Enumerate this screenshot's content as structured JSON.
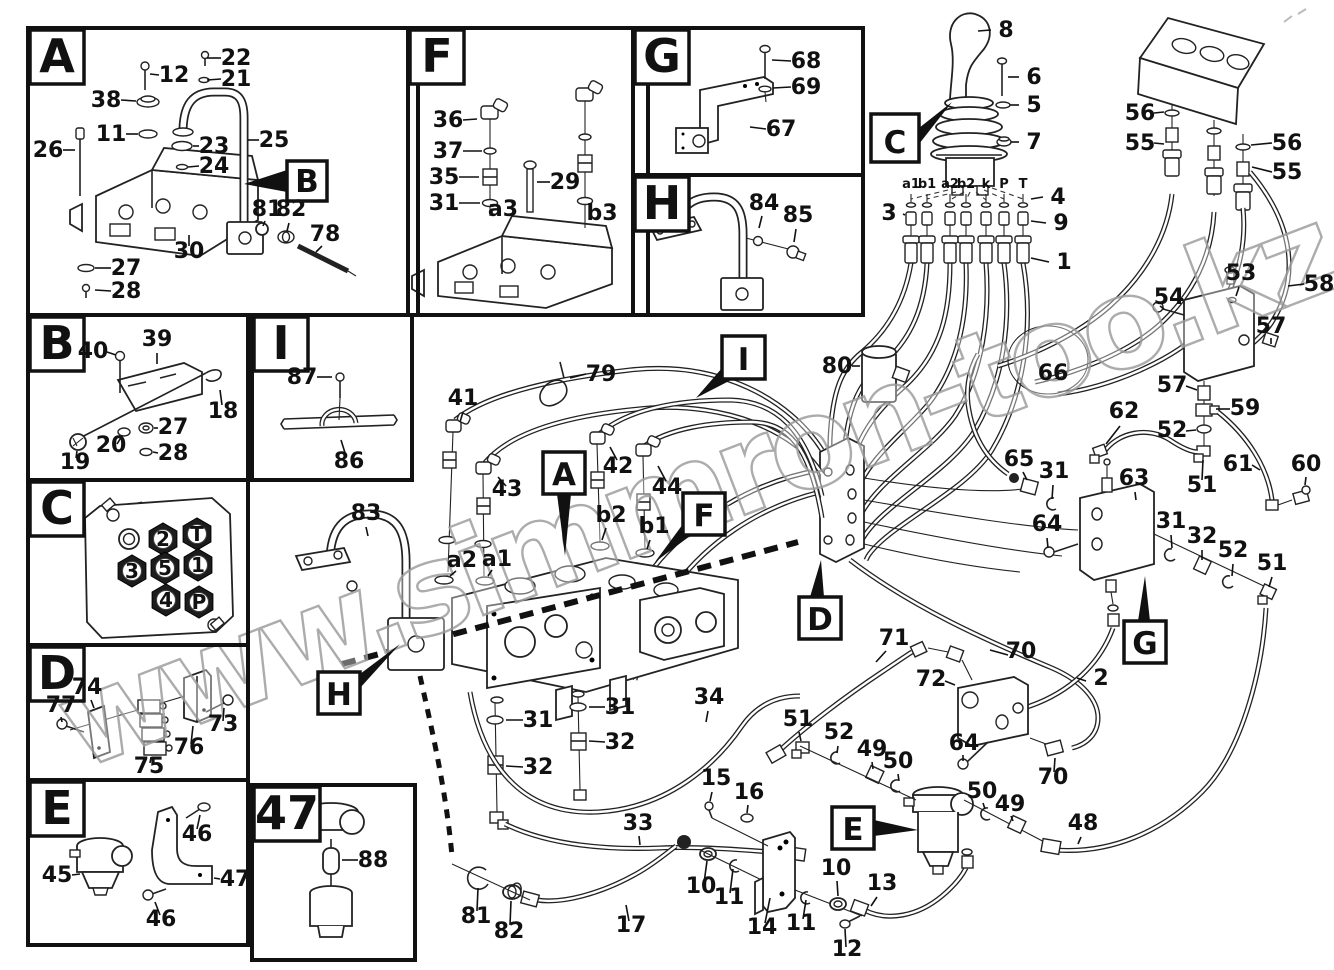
{
  "watermark": {
    "text": "www.simmron-too.kz"
  },
  "colors": {
    "line": "#1a1a1a",
    "background": "#ffffff",
    "watermark": "#9e9e9e"
  },
  "sections": [
    {
      "id": "A",
      "label": "A",
      "x": 28,
      "y": 28,
      "w": 390,
      "h": 287
    },
    {
      "id": "F",
      "label": "F",
      "x": 408,
      "y": 28,
      "w": 240,
      "h": 287
    },
    {
      "id": "G",
      "label": "G",
      "x": 633,
      "y": 28,
      "w": 230,
      "h": 147
    },
    {
      "id": "H",
      "label": "H",
      "x": 633,
      "y": 175,
      "w": 230,
      "h": 140
    },
    {
      "id": "B",
      "label": "B",
      "x": 28,
      "y": 315,
      "w": 220,
      "h": 165
    },
    {
      "id": "I",
      "label": "I",
      "x": 252,
      "y": 315,
      "w": 160,
      "h": 165
    },
    {
      "id": "C",
      "label": "C",
      "x": 28,
      "y": 480,
      "w": 220,
      "h": 165
    },
    {
      "id": "D",
      "label": "D",
      "x": 28,
      "y": 645,
      "w": 220,
      "h": 135
    },
    {
      "id": "E",
      "label": "E",
      "x": 28,
      "y": 780,
      "w": 220,
      "h": 165
    },
    {
      "id": "47",
      "label": "47",
      "x": 252,
      "y": 785,
      "w": 163,
      "h": 175,
      "lw": 66
    }
  ],
  "callouts": [
    {
      "ref": "b-in-a",
      "label": "B",
      "x": 287,
      "y": 161,
      "s": 40,
      "tri": "287,170 287,192 244,184"
    },
    {
      "ref": "c-main",
      "label": "C",
      "x": 871,
      "y": 114,
      "s": 48,
      "tri": "919,128 919,144 952,102"
    },
    {
      "ref": "a-main",
      "label": "A",
      "x": 543,
      "y": 452,
      "s": 42,
      "tri": "557,494 571,494 565,556"
    },
    {
      "ref": "f-main",
      "label": "F",
      "x": 683,
      "y": 493,
      "s": 42,
      "tri": "683,524 694,533 655,562"
    },
    {
      "ref": "i-main",
      "label": "I",
      "x": 722,
      "y": 336,
      "s": 43,
      "tri": "722,368 733,379 696,398"
    },
    {
      "ref": "d-main",
      "label": "D",
      "x": 799,
      "y": 597,
      "s": 42,
      "tri": "810,597 824,597 821,560"
    },
    {
      "ref": "g-main",
      "label": "G",
      "x": 1124,
      "y": 621,
      "s": 42,
      "tri": "1138,621 1150,621 1145,576"
    },
    {
      "ref": "h-main",
      "label": "H",
      "x": 318,
      "y": 672,
      "s": 42,
      "tri": "360,674 360,688 400,644"
    },
    {
      "ref": "e-main",
      "label": "E",
      "x": 832,
      "y": 807,
      "s": 42,
      "tri": "874,820 874,836 918,830"
    }
  ],
  "joystick_ports": [
    {
      "t": "a1",
      "x": 911
    },
    {
      "t": "b1",
      "x": 927
    },
    {
      "t": "a2",
      "x": 950
    },
    {
      "t": "b2",
      "x": 966
    },
    {
      "t": "k",
      "x": 986
    },
    {
      "t": "P",
      "x": 1004
    },
    {
      "t": "T",
      "x": 1023
    }
  ],
  "port_row": {
    "label_y": 188
  },
  "connector_ports": [
    {
      "t": "2",
      "x": 163,
      "y": 539
    },
    {
      "t": "T",
      "x": 197,
      "y": 534
    },
    {
      "t": "3",
      "x": 132,
      "y": 571
    },
    {
      "t": "5",
      "x": 165,
      "y": 568
    },
    {
      "t": "1",
      "x": 198,
      "y": 565
    },
    {
      "t": "4",
      "x": 166,
      "y": 600
    },
    {
      "t": "P",
      "x": 199,
      "y": 602
    }
  ],
  "part_labels": [
    {
      "t": "22",
      "x": 236,
      "y": 65,
      "l": [
        221,
        58,
        207,
        58
      ]
    },
    {
      "t": "21",
      "x": 236,
      "y": 86,
      "l": [
        221,
        79,
        207,
        80
      ]
    },
    {
      "t": "12",
      "x": 174,
      "y": 82,
      "l": [
        159,
        75,
        150,
        74
      ]
    },
    {
      "t": "38",
      "x": 106,
      "y": 107,
      "l": [
        121,
        100,
        136,
        101
      ]
    },
    {
      "t": "11",
      "x": 111,
      "y": 141,
      "l": [
        126,
        134,
        138,
        134
      ]
    },
    {
      "t": "26",
      "x": 48,
      "y": 157,
      "l": [
        63,
        150,
        75,
        150
      ]
    },
    {
      "t": "23",
      "x": 214,
      "y": 153,
      "l": [
        199,
        146,
        193,
        146
      ]
    },
    {
      "t": "24",
      "x": 214,
      "y": 173,
      "l": [
        199,
        166,
        188,
        167
      ]
    },
    {
      "t": "25",
      "x": 274,
      "y": 147,
      "l": [
        259,
        140,
        248,
        140
      ]
    },
    {
      "t": "81",
      "x": 267,
      "y": 216,
      "l": [
        265,
        221,
        263,
        226
      ]
    },
    {
      "t": "82",
      "x": 291,
      "y": 216,
      "l": [
        289,
        223,
        287,
        231
      ]
    },
    {
      "t": "78",
      "x": 325,
      "y": 241,
      "l": [
        322,
        246,
        316,
        252
      ]
    },
    {
      "t": "30",
      "x": 189,
      "y": 258,
      "l": [
        189,
        246,
        189,
        235
      ]
    },
    {
      "t": "27",
      "x": 126,
      "y": 275,
      "l": [
        111,
        268,
        95,
        268
      ]
    },
    {
      "t": "28",
      "x": 126,
      "y": 298,
      "l": [
        111,
        291,
        95,
        290
      ]
    },
    {
      "t": "40",
      "x": 93,
      "y": 358,
      "l": [
        107,
        352,
        116,
        355
      ]
    },
    {
      "t": "39",
      "x": 157,
      "y": 346,
      "l": [
        157,
        353,
        157,
        364
      ]
    },
    {
      "t": "18",
      "x": 223,
      "y": 418,
      "l": [
        222,
        405,
        220,
        390
      ]
    },
    {
      "t": "27",
      "x": 173,
      "y": 434,
      "l": [
        158,
        428,
        154,
        428
      ]
    },
    {
      "t": "20",
      "x": 111,
      "y": 452,
      "l": [
        117,
        444,
        122,
        436
      ]
    },
    {
      "t": "28",
      "x": 173,
      "y": 460,
      "l": [
        158,
        453,
        153,
        452
      ]
    },
    {
      "t": "19",
      "x": 75,
      "y": 469,
      "l": [
        76,
        458,
        77,
        451
      ]
    },
    {
      "t": "77",
      "x": 61,
      "y": 712,
      "l": [
        61,
        717,
        62,
        722
      ]
    },
    {
      "t": "74",
      "x": 87,
      "y": 694,
      "l": [
        91,
        700,
        94,
        708
      ]
    },
    {
      "t": "75",
      "x": 149,
      "y": 773,
      "l": [
        150,
        763,
        151,
        757
      ]
    },
    {
      "t": "76",
      "x": 189,
      "y": 754,
      "l": [
        191,
        744,
        193,
        726
      ]
    },
    {
      "t": "73",
      "x": 223,
      "y": 731,
      "l": [
        223,
        721,
        224,
        708
      ]
    },
    {
      "t": "46",
      "x": 197,
      "y": 841,
      "l": [
        197,
        829,
        200,
        815
      ]
    },
    {
      "t": "45",
      "x": 57,
      "y": 882,
      "l": [
        72,
        875,
        80,
        874
      ]
    },
    {
      "t": "47",
      "x": 235,
      "y": 886,
      "l": [
        220,
        879,
        214,
        878
      ]
    },
    {
      "t": "46",
      "x": 161,
      "y": 926,
      "l": [
        160,
        915,
        155,
        902
      ]
    },
    {
      "t": "87",
      "x": 302,
      "y": 384,
      "l": [
        317,
        377,
        332,
        377
      ]
    },
    {
      "t": "86",
      "x": 349,
      "y": 468,
      "l": [
        346,
        456,
        341,
        440
      ]
    },
    {
      "t": "88",
      "x": 373,
      "y": 867,
      "l": [
        358,
        860,
        342,
        860
      ]
    },
    {
      "t": "36",
      "x": 448,
      "y": 127,
      "l": [
        463,
        120,
        477,
        119
      ]
    },
    {
      "t": "37",
      "x": 448,
      "y": 158,
      "l": [
        463,
        151,
        482,
        151
      ]
    },
    {
      "t": "35",
      "x": 444,
      "y": 184,
      "l": [
        459,
        177,
        479,
        177
      ]
    },
    {
      "t": "31",
      "x": 444,
      "y": 210,
      "l": [
        459,
        203,
        480,
        203
      ]
    },
    {
      "t": "29",
      "x": 565,
      "y": 189,
      "l": [
        550,
        182,
        537,
        182
      ]
    },
    {
      "t": "a3",
      "x": 503,
      "y": 216
    },
    {
      "t": "b3",
      "x": 602,
      "y": 220
    },
    {
      "t": "68",
      "x": 806,
      "y": 68,
      "l": [
        791,
        61,
        772,
        60
      ]
    },
    {
      "t": "69",
      "x": 806,
      "y": 94,
      "l": [
        791,
        87,
        773,
        88
      ]
    },
    {
      "t": "67",
      "x": 781,
      "y": 136,
      "l": [
        766,
        129,
        750,
        127
      ]
    },
    {
      "t": "84",
      "x": 764,
      "y": 210,
      "l": [
        762,
        216,
        759,
        228
      ]
    },
    {
      "t": "85",
      "x": 798,
      "y": 222,
      "l": [
        796,
        229,
        794,
        242
      ]
    },
    {
      "t": "8",
      "x": 1006,
      "y": 37,
      "l": [
        991,
        30,
        978,
        31
      ]
    },
    {
      "t": "6",
      "x": 1034,
      "y": 84,
      "l": [
        1019,
        77,
        1008,
        77
      ]
    },
    {
      "t": "5",
      "x": 1034,
      "y": 112,
      "l": [
        1019,
        105,
        1010,
        105
      ]
    },
    {
      "t": "7",
      "x": 1034,
      "y": 149,
      "l": [
        1019,
        142,
        1011,
        142
      ]
    },
    {
      "t": "4",
      "x": 1058,
      "y": 204,
      "l": [
        1043,
        197,
        1031,
        199
      ]
    },
    {
      "t": "3",
      "x": 889,
      "y": 220,
      "l": [
        903,
        214,
        905,
        215
      ]
    },
    {
      "t": "9",
      "x": 1061,
      "y": 230,
      "l": [
        1046,
        223,
        1031,
        221
      ]
    },
    {
      "t": "1",
      "x": 1064,
      "y": 269,
      "l": [
        1049,
        262,
        1031,
        258
      ]
    },
    {
      "t": "56",
      "x": 1140,
      "y": 120,
      "l": [
        1154,
        113,
        1164,
        112
      ]
    },
    {
      "t": "55",
      "x": 1140,
      "y": 150,
      "l": [
        1154,
        143,
        1164,
        144
      ]
    },
    {
      "t": "56",
      "x": 1287,
      "y": 150,
      "l": [
        1272,
        143,
        1251,
        145
      ]
    },
    {
      "t": "55",
      "x": 1287,
      "y": 179,
      "l": [
        1272,
        172,
        1252,
        167
      ]
    },
    {
      "t": "58",
      "x": 1319,
      "y": 291,
      "l": [
        1304,
        284,
        1288,
        286
      ]
    },
    {
      "t": "53",
      "x": 1241,
      "y": 280,
      "l": [
        1239,
        287,
        1236,
        296
      ]
    },
    {
      "t": "54",
      "x": 1169,
      "y": 304,
      "l": [
        1164,
        309,
        1160,
        306
      ]
    },
    {
      "t": "57",
      "x": 1271,
      "y": 333,
      "l": [
        1271,
        338,
        1271,
        344
      ]
    },
    {
      "t": "57",
      "x": 1172,
      "y": 392,
      "l": [
        1186,
        386,
        1197,
        390
      ]
    },
    {
      "t": "59",
      "x": 1245,
      "y": 415,
      "l": [
        1230,
        409,
        1216,
        409
      ]
    },
    {
      "t": "62",
      "x": 1124,
      "y": 418,
      "l": [
        1120,
        426,
        1106,
        444
      ]
    },
    {
      "t": "52",
      "x": 1172,
      "y": 437,
      "l": [
        1186,
        431,
        1196,
        430
      ]
    },
    {
      "t": "61",
      "x": 1238,
      "y": 471,
      "l": [
        1252,
        465,
        1260,
        470
      ]
    },
    {
      "t": "60",
      "x": 1306,
      "y": 471,
      "l": [
        1306,
        477,
        1305,
        485
      ]
    },
    {
      "t": "51",
      "x": 1202,
      "y": 492,
      "l": [
        1202,
        480,
        1203,
        460
      ]
    },
    {
      "t": "66",
      "x": 1053,
      "y": 380
    },
    {
      "t": "80",
      "x": 837,
      "y": 373,
      "l": [
        852,
        366,
        860,
        366
      ]
    },
    {
      "t": "65",
      "x": 1019,
      "y": 466,
      "l": [
        1023,
        472,
        1027,
        480
      ]
    },
    {
      "t": "31",
      "x": 1054,
      "y": 478,
      "l": [
        1053,
        485,
        1052,
        499
      ]
    },
    {
      "t": "64",
      "x": 1047,
      "y": 531,
      "l": [
        1047,
        538,
        1048,
        548
      ]
    },
    {
      "t": "63",
      "x": 1134,
      "y": 485,
      "l": [
        1135,
        492,
        1136,
        500
      ]
    },
    {
      "t": "31",
      "x": 1171,
      "y": 528,
      "l": [
        1171,
        535,
        1172,
        548
      ]
    },
    {
      "t": "32",
      "x": 1202,
      "y": 543,
      "l": [
        1202,
        550,
        1202,
        560
      ]
    },
    {
      "t": "52",
      "x": 1233,
      "y": 557,
      "l": [
        1233,
        564,
        1232,
        576
      ]
    },
    {
      "t": "51",
      "x": 1272,
      "y": 570,
      "l": [
        1272,
        577,
        1269,
        587
      ]
    },
    {
      "t": "79",
      "x": 601,
      "y": 381,
      "l": [
        586,
        374,
        570,
        378
      ]
    },
    {
      "t": "41",
      "x": 463,
      "y": 405,
      "l": [
        463,
        412,
        460,
        422
      ]
    },
    {
      "t": "43",
      "x": 507,
      "y": 496,
      "l": [
        506,
        486,
        498,
        477
      ]
    },
    {
      "t": "42",
      "x": 618,
      "y": 473,
      "l": [
        617,
        460,
        610,
        447
      ]
    },
    {
      "t": "44",
      "x": 667,
      "y": 494,
      "l": [
        666,
        481,
        658,
        466
      ]
    },
    {
      "t": "b2",
      "x": 611,
      "y": 522,
      "l": [
        606,
        528,
        602,
        540
      ]
    },
    {
      "t": "b1",
      "x": 654,
      "y": 533,
      "l": [
        650,
        540,
        647,
        549
      ]
    },
    {
      "t": "a2",
      "x": 462,
      "y": 567,
      "l": [
        456,
        571,
        450,
        576
      ]
    },
    {
      "t": "a1",
      "x": 497,
      "y": 566,
      "l": [
        492,
        570,
        488,
        576
      ]
    },
    {
      "t": "83",
      "x": 366,
      "y": 520,
      "l": [
        366,
        527,
        368,
        536
      ]
    },
    {
      "t": "31",
      "x": 538,
      "y": 727,
      "l": [
        523,
        720,
        506,
        720
      ]
    },
    {
      "t": "32",
      "x": 538,
      "y": 774,
      "l": [
        523,
        767,
        506,
        766
      ]
    },
    {
      "t": "31",
      "x": 620,
      "y": 714,
      "l": [
        605,
        707,
        589,
        707
      ]
    },
    {
      "t": "32",
      "x": 620,
      "y": 749,
      "l": [
        605,
        742,
        589,
        741
      ]
    },
    {
      "t": "34",
      "x": 709,
      "y": 704,
      "l": [
        708,
        711,
        706,
        722
      ]
    },
    {
      "t": "33",
      "x": 638,
      "y": 830,
      "l": [
        639,
        836,
        640,
        845
      ]
    },
    {
      "t": "71",
      "x": 894,
      "y": 645,
      "l": [
        886,
        651,
        876,
        662
      ]
    },
    {
      "t": "72",
      "x": 931,
      "y": 686,
      "l": [
        945,
        681,
        955,
        685
      ]
    },
    {
      "t": "70",
      "x": 1021,
      "y": 658,
      "l": [
        1008,
        655,
        990,
        650
      ]
    },
    {
      "t": "2",
      "x": 1101,
      "y": 685,
      "l": [
        1086,
        681,
        1077,
        678
      ]
    },
    {
      "t": "64",
      "x": 964,
      "y": 750,
      "l": [
        963,
        755,
        963,
        761
      ]
    },
    {
      "t": "70",
      "x": 1053,
      "y": 784,
      "l": [
        1054,
        772,
        1055,
        758
      ]
    },
    {
      "t": "51",
      "x": 798,
      "y": 726,
      "l": [
        799,
        732,
        801,
        741
      ]
    },
    {
      "t": "52",
      "x": 839,
      "y": 739,
      "l": [
        838,
        746,
        837,
        753
      ]
    },
    {
      "t": "49",
      "x": 872,
      "y": 756,
      "l": [
        872,
        762,
        873,
        769
      ]
    },
    {
      "t": "50",
      "x": 898,
      "y": 768,
      "l": [
        898,
        774,
        899,
        781
      ]
    },
    {
      "t": "15",
      "x": 716,
      "y": 785,
      "l": [
        712,
        792,
        710,
        801
      ]
    },
    {
      "t": "16",
      "x": 749,
      "y": 799,
      "l": [
        748,
        805,
        747,
        813
      ]
    },
    {
      "t": "50",
      "x": 982,
      "y": 798,
      "l": [
        983,
        803,
        985,
        809
      ]
    },
    {
      "t": "49",
      "x": 1010,
      "y": 811,
      "l": [
        1011,
        816,
        1013,
        821
      ]
    },
    {
      "t": "48",
      "x": 1083,
      "y": 830,
      "l": [
        1081,
        837,
        1078,
        844
      ]
    },
    {
      "t": "10",
      "x": 701,
      "y": 893,
      "l": [
        704,
        883,
        707,
        861
      ]
    },
    {
      "t": "11",
      "x": 729,
      "y": 904,
      "l": [
        730,
        893,
        733,
        869
      ]
    },
    {
      "t": "14",
      "x": 762,
      "y": 934,
      "l": [
        765,
        923,
        770,
        898
      ]
    },
    {
      "t": "11",
      "x": 801,
      "y": 930,
      "l": [
        803,
        919,
        806,
        900
      ]
    },
    {
      "t": "10",
      "x": 836,
      "y": 875,
      "l": [
        837,
        881,
        838,
        896
      ]
    },
    {
      "t": "12",
      "x": 847,
      "y": 956,
      "l": [
        846,
        947,
        845,
        929
      ]
    },
    {
      "t": "13",
      "x": 882,
      "y": 890,
      "l": [
        877,
        897,
        871,
        906
      ]
    },
    {
      "t": "17",
      "x": 631,
      "y": 932,
      "l": [
        629,
        921,
        626,
        905
      ]
    },
    {
      "t": "81",
      "x": 476,
      "y": 923,
      "l": [
        477,
        911,
        478,
        888
      ]
    },
    {
      "t": "82",
      "x": 509,
      "y": 938,
      "l": [
        510,
        925,
        511,
        901
      ]
    }
  ]
}
